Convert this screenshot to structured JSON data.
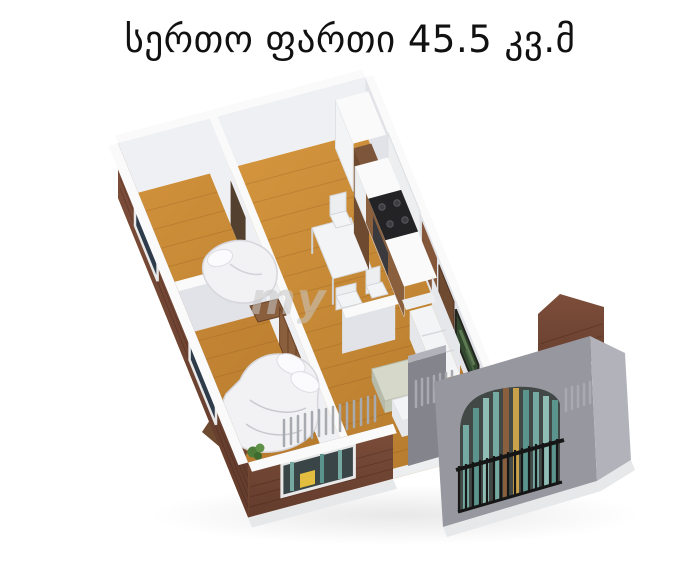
{
  "title": {
    "text": "სერთო ფართი 45.5 კვ.მ",
    "area_value": "45.5",
    "area_unit": "კვ.მ"
  },
  "watermark": {
    "text": "my"
  },
  "illustration": {
    "kind": "3d-isometric-apartment-floor-plan"
  },
  "colors": {
    "background": "#ffffff",
    "title_text": "#111111",
    "floor_light": "#dc9c42",
    "floor_dark": "#b0762a",
    "brick": "#7d4e3a",
    "brick_dark": "#633c2d",
    "wall_white": "#eff0f3",
    "wall_shadow": "#e2e3e8",
    "wall_top": "#fafafa",
    "concrete": "#97979f",
    "concrete_light": "#b2b3ba",
    "concrete_dark": "#84858c",
    "railing": "#161616",
    "glass_teal": "#74aaa2",
    "glass_dark": "#2e3b4a",
    "bed_white": "#f2f2f5",
    "wood_furniture": "#8a5f3e",
    "stove_black": "#232326",
    "tv_green": "#32492f",
    "accent_yellow": "#e3bd3f",
    "plant_green": "#4e7d3a",
    "watermark": "#c7c7c7"
  }
}
